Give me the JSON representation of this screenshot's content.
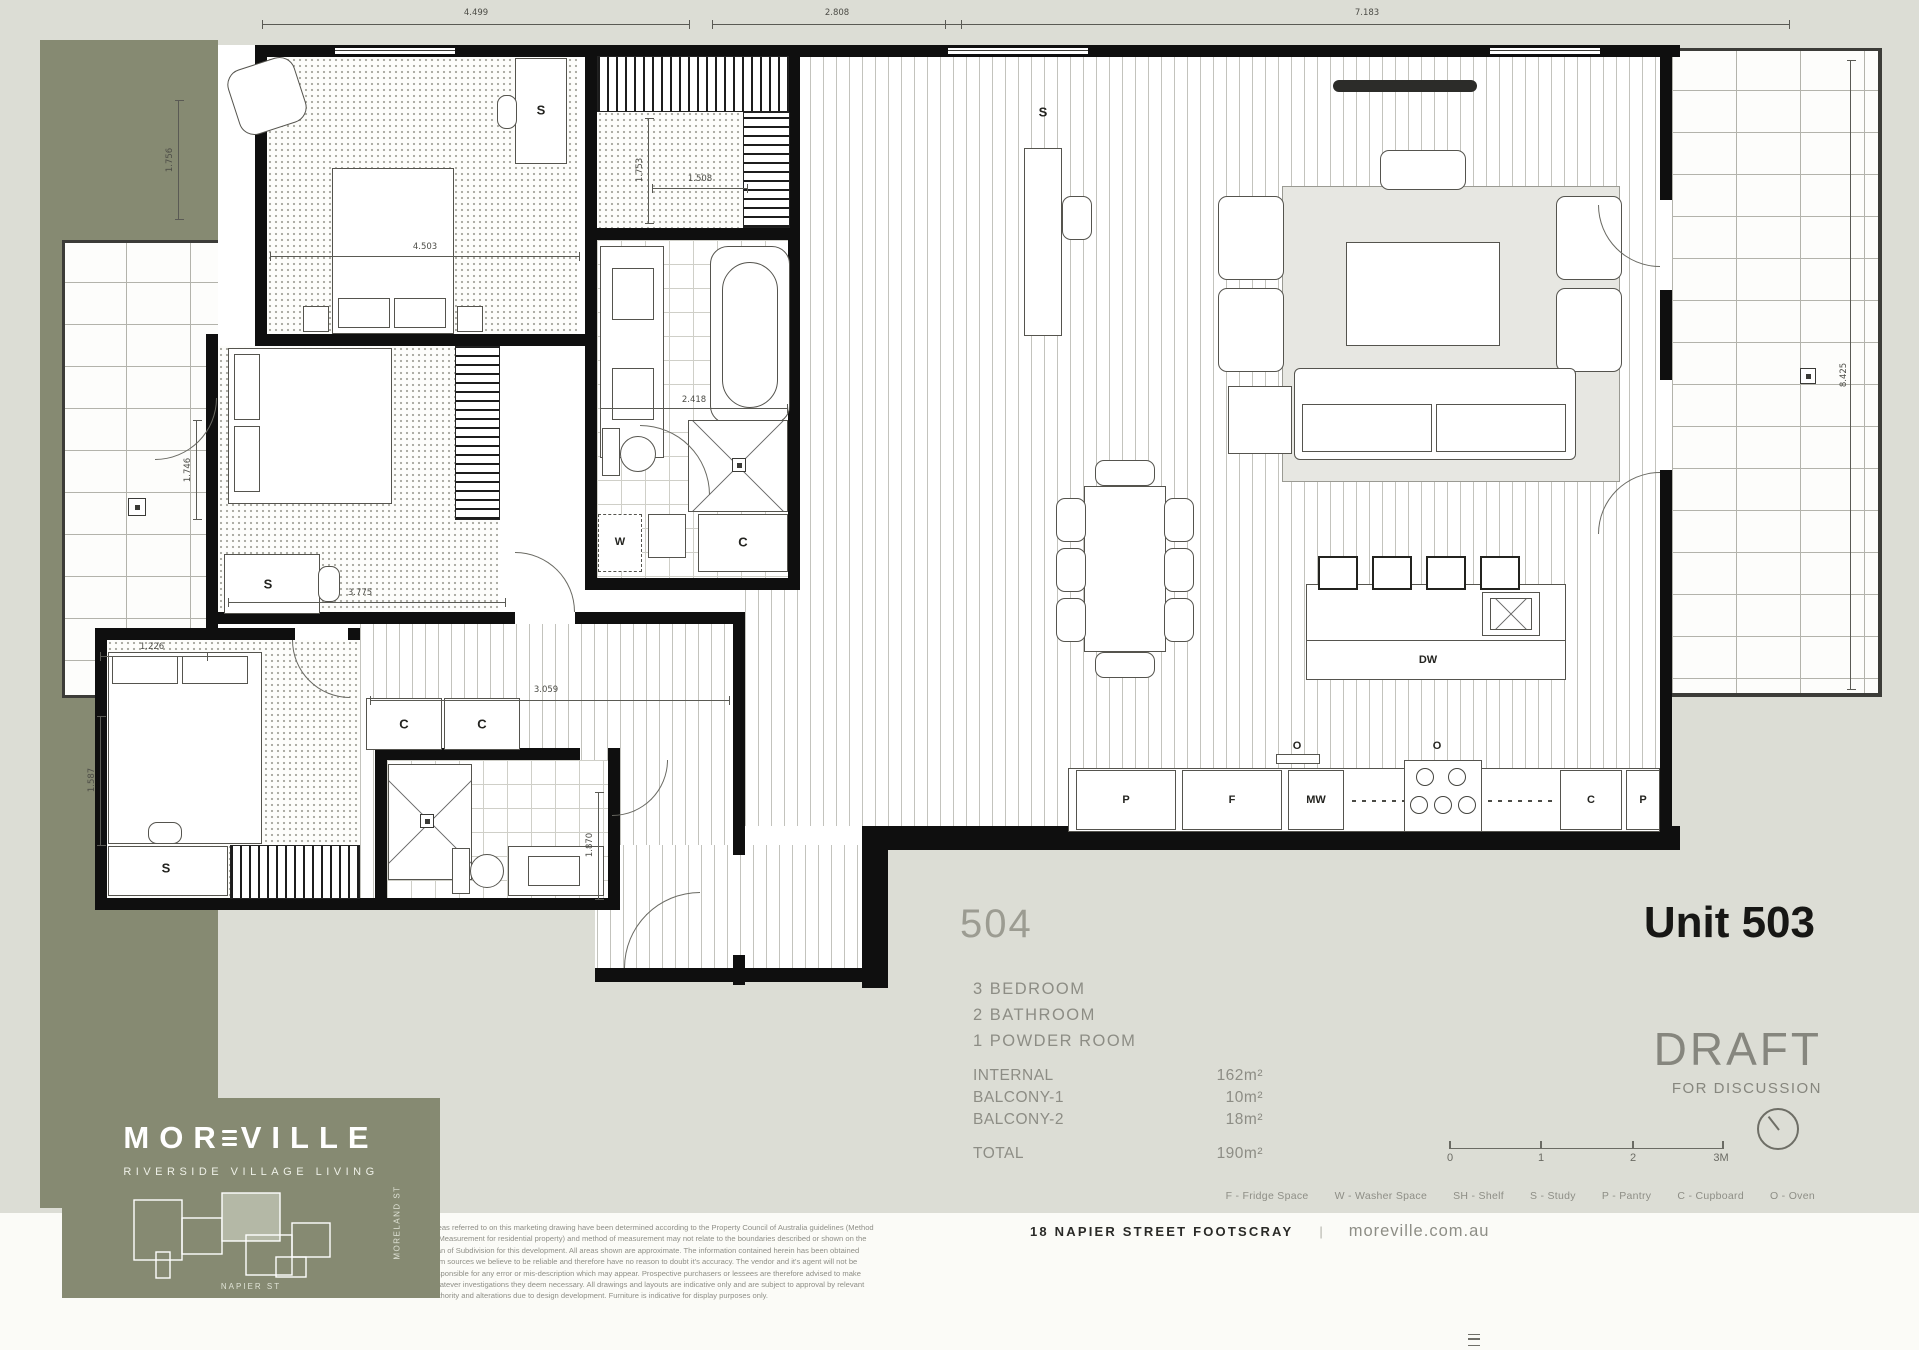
{
  "page": {
    "background": "#dcddd5",
    "accent_olive": "#868a72"
  },
  "units": {
    "neighbor": "504",
    "current": "Unit 503"
  },
  "summary": {
    "bedrooms": "3  BEDROOM",
    "bathrooms": "2  BATHROOM",
    "powder": "1  POWDER ROOM",
    "rows": [
      {
        "label": "INTERNAL",
        "value": "162m²"
      },
      {
        "label": "BALCONY-1",
        "value": "10m²"
      },
      {
        "label": "BALCONY-2",
        "value": "18m²"
      }
    ],
    "total": {
      "label": "TOTAL",
      "value": "190m²"
    }
  },
  "status": {
    "draft": "DRAFT",
    "for_discussion": "FOR DISCUSSION"
  },
  "scalebar": {
    "t0": "0",
    "t1": "1",
    "t2": "2",
    "t3": "3M"
  },
  "legend": {
    "items": [
      "F - Fridge Space",
      "W - Washer Space",
      "SH - Shelf",
      "S - Study",
      "P - Pantry",
      "C - Cupboard",
      "O - Oven"
    ]
  },
  "footer": {
    "address": "18 NAPIER STREET FOOTSCRAY",
    "separator": "|",
    "website": "moreville.com.au"
  },
  "logo": {
    "name_pre": "MOR",
    "name_post": "VILLE",
    "tagline": "RIVERSIDE VILLAGE LIVING",
    "street_bottom": "NAPIER ST",
    "street_side": "MORELAND ST"
  },
  "fixtures": {
    "study": "S",
    "washer": "W",
    "cupboard": "C",
    "pantry": "P",
    "fridge": "F",
    "microwave": "MW",
    "dishwasher": "DW",
    "oven": "O"
  },
  "dimensions": {
    "top_left": "4.499",
    "top_mid": "2.808",
    "top_right": "7.183",
    "right_side": "8.425",
    "master_width": "4.503",
    "bed2_width": "3.775",
    "bath_width": "2.418",
    "hall_width": "3.059",
    "wir_depth": "1.753",
    "wir_width": "1.508",
    "bed3_top": "1.226",
    "bed3_side": "1.587",
    "entry_side": "1.870",
    "left_upper": "1.756",
    "left_lower": "1.746"
  },
  "disclaimer": "Areas referred to on this marketing drawing have been determined according to the Property Council of Australia guidelines (Method of Measurement for residential property) and method of measurement may not relate to the boundaries described or shown on the Plan of Subdivision for this development. All areas shown are approximate. The information contained herein has been obtained from sources we believe to be reliable and therefore have no reason to doubt it's accuracy. The vendor and it's agent will not be responsible for any error or mis-description which may appear. Prospective purchasers or lessees are therefore advised to make whatever investigations they deem necessary. All drawings and layouts are indicative only and are subject to approval by relevant authority and alterations due to design development. Furniture is indicative for display purposes only."
}
